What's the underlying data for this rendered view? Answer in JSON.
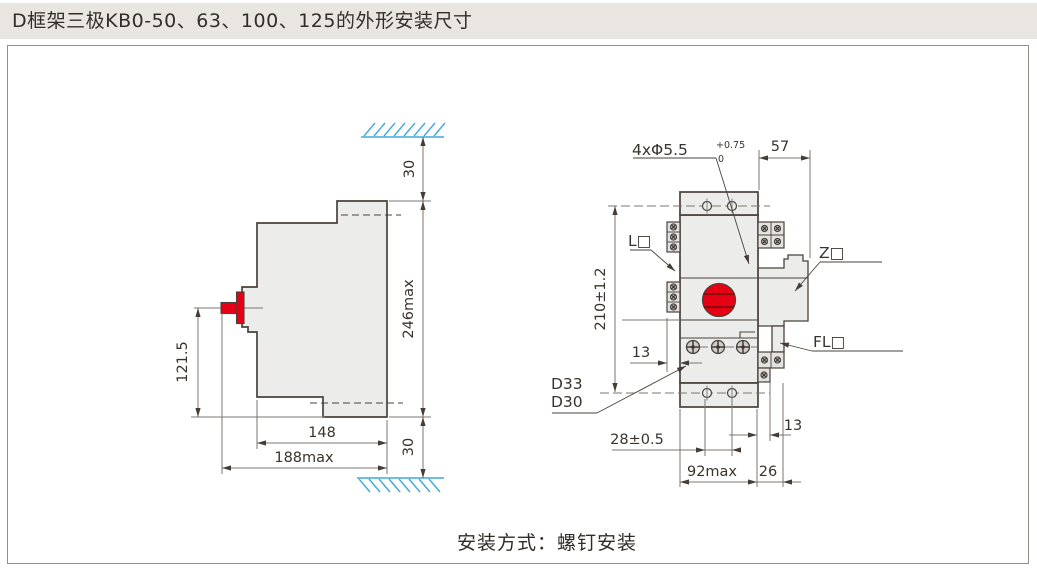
{
  "header": {
    "title": "D框架三极KB0-50、63、100、125的外形安装尺寸"
  },
  "footer": {
    "caption": "安装方式：螺钉安装"
  },
  "colors": {
    "outline": "#4a423b",
    "body_fill": "#ececeb",
    "accent_red": "#e60013",
    "hatch_blue": "#3fa8dd",
    "dim_gray": "#7b7672",
    "titlebar_bg": "#e9e6e2"
  },
  "side_view": {
    "dim_top_clearance": "30",
    "dim_height_max": "246max",
    "dim_handle_height": "121.5",
    "dim_depth": "148",
    "dim_depth_max": "188max",
    "dim_bottom_clearance": "30"
  },
  "front_view": {
    "mounting_holes_label": "4xΦ5.5",
    "mounting_holes_tol_sup": "+0.75",
    "mounting_holes_tol_sub": "0",
    "accessory_left_label": "L□",
    "accessory_right_label": "Z□",
    "accessory_fl_label": "FL□",
    "model_label_1": "D33",
    "model_label_2": "D30",
    "dim_side_width": "57",
    "dim_hole_pitch_vertical": "210±1.2",
    "dim_terminal_depth": "13",
    "dim_hole_pitch_horizontal": "28±0.5",
    "dim_width_max": "92max",
    "dim_block_width": "26",
    "dim_right_offset": "13"
  }
}
